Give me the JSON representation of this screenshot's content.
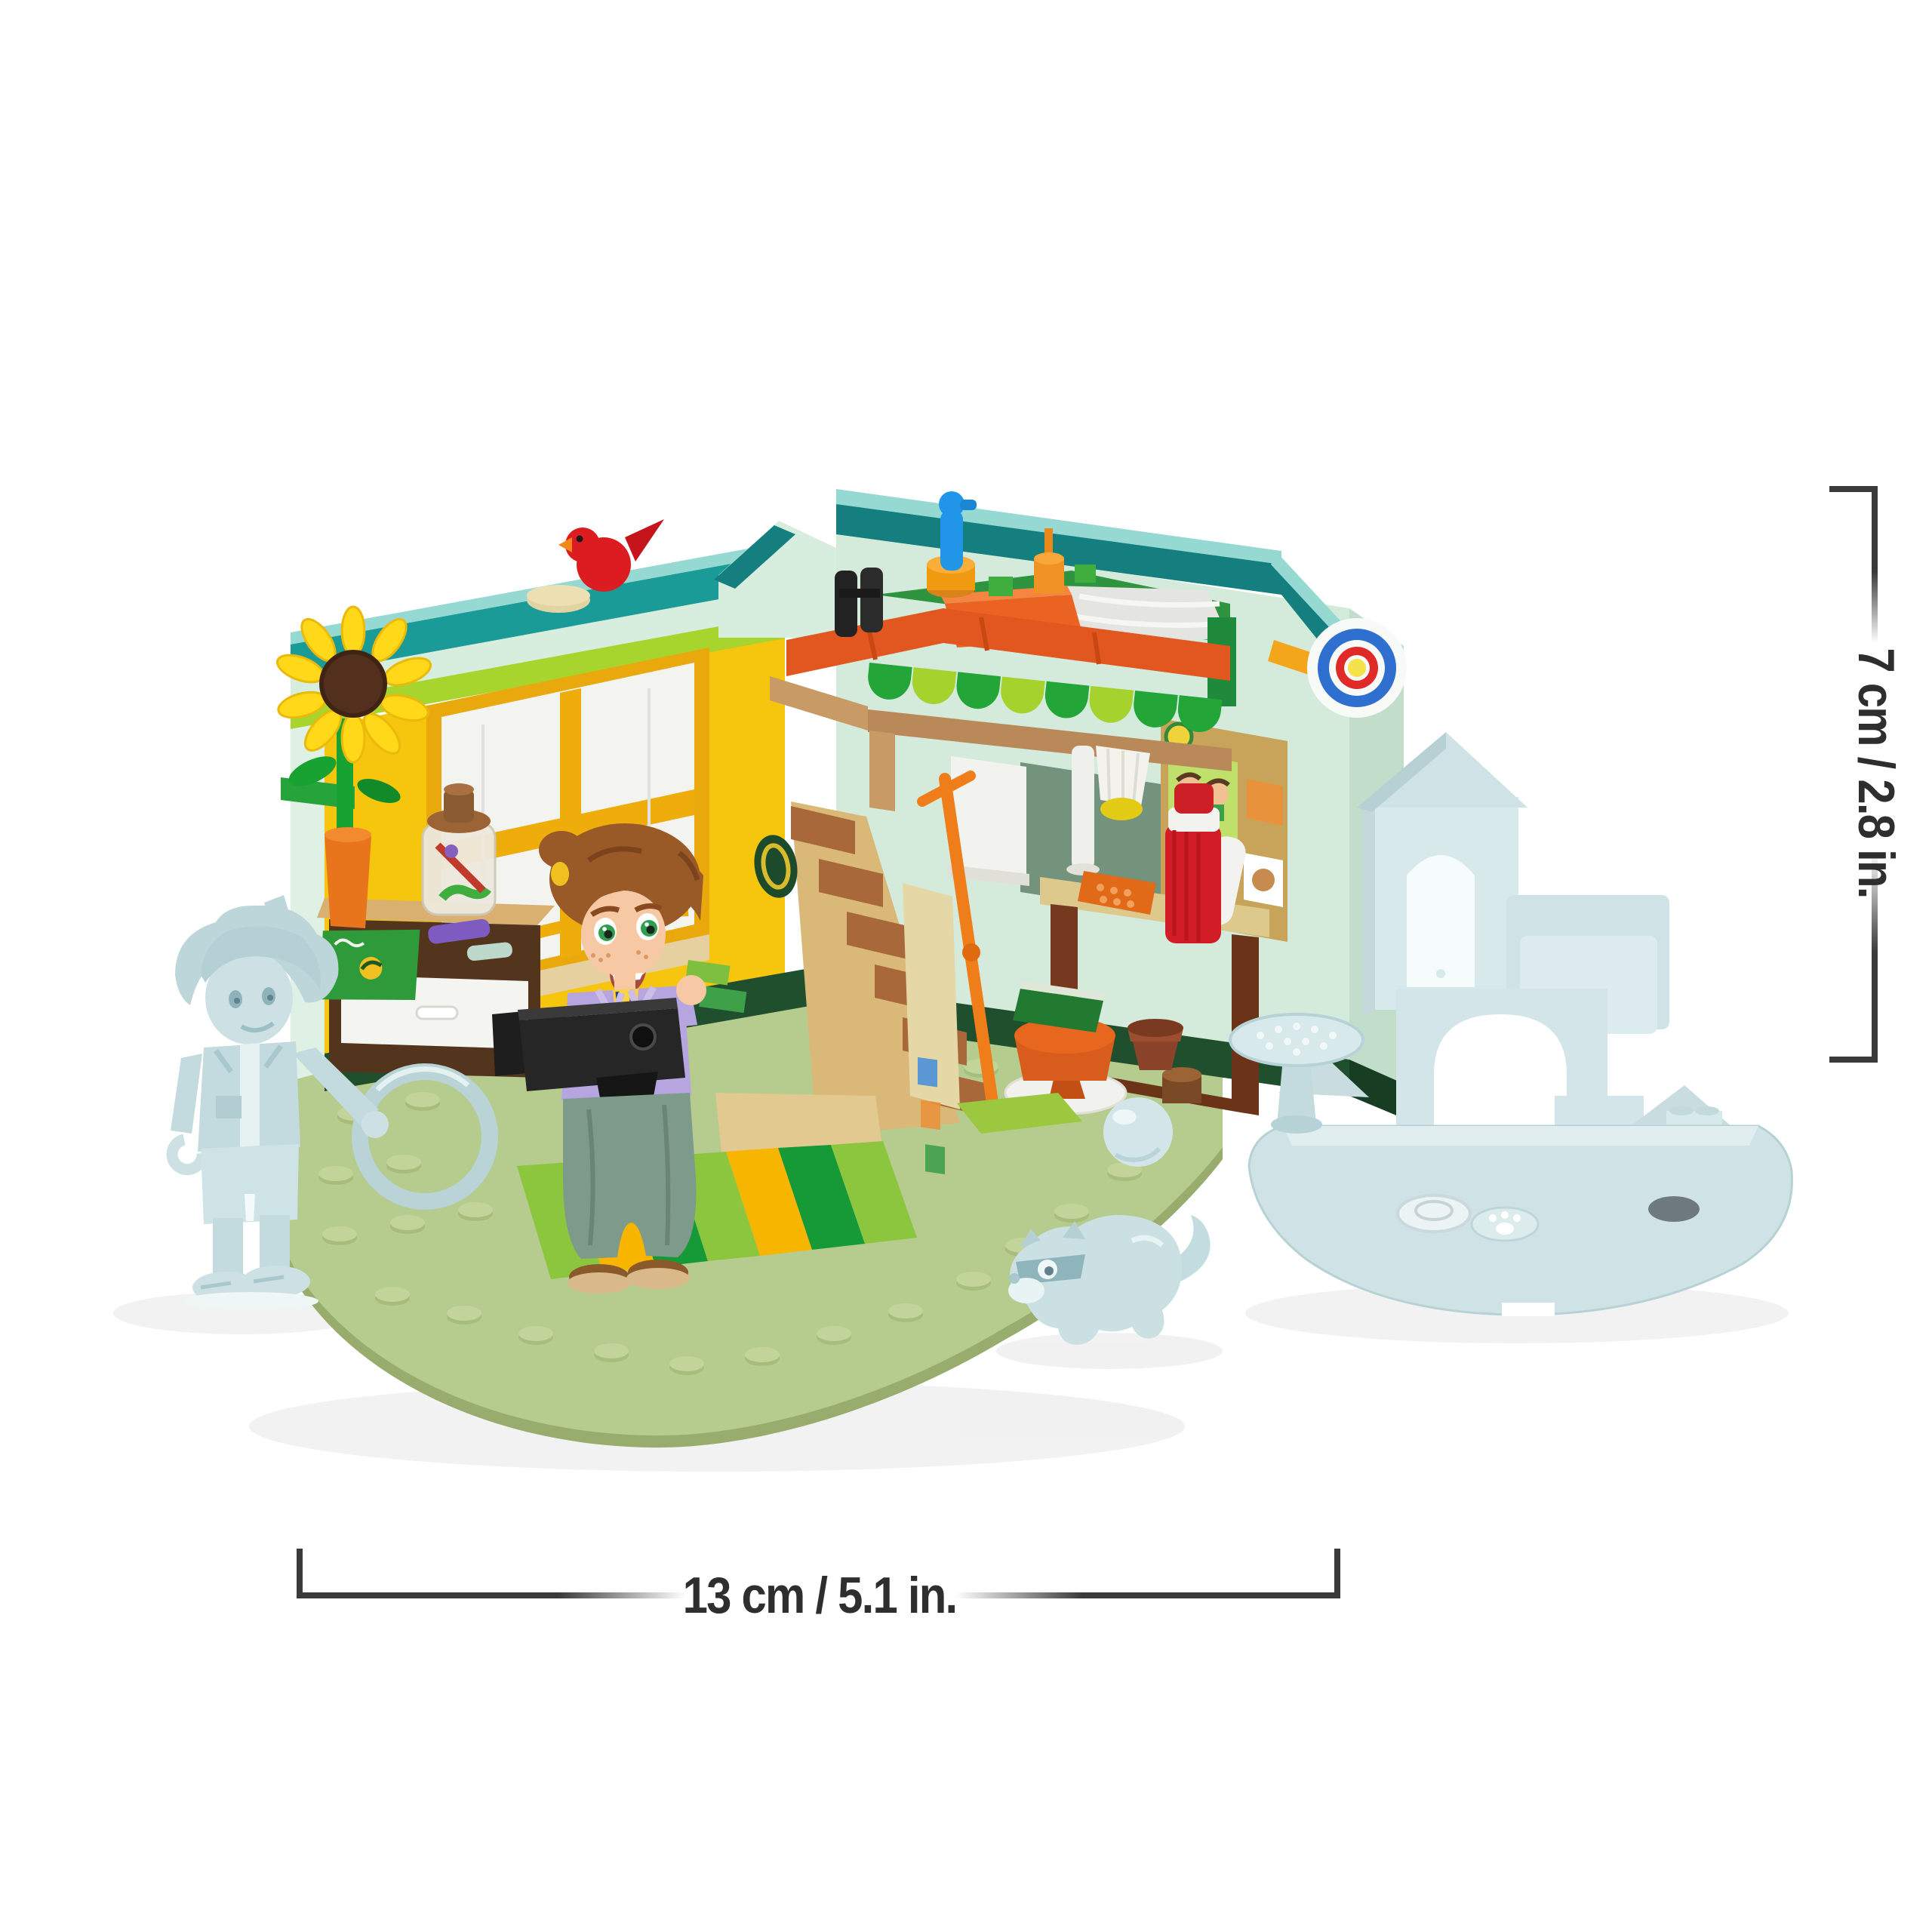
{
  "image": {
    "kind": "product-dimensions-photo",
    "background": "#ffffff",
    "subject": "LEGO Friends style bedroom playset with mini-doll photographer, translucent preview boy figure with hoop, translucent ferret and ball, and translucent rocking-castle build"
  },
  "annotations": {
    "height_label": "7 cm / 2.8 in.",
    "width_label": "13 cm / 5.1 in.",
    "line_color": "#3a3a3a",
    "text_color": "#2e2e2e"
  },
  "scene": {
    "objects": [
      "base-plate",
      "left-wall-with-bay-window",
      "corner-gable",
      "right-wall",
      "photo-collage",
      "archery-target",
      "loft-bed",
      "awning-scallops",
      "bed-blanket",
      "binoculars",
      "blue-statue",
      "staircase",
      "orange-pole",
      "roller-blind",
      "table-lamp",
      "desk",
      "thermos",
      "orange-phone",
      "stool-with-book",
      "white-rug",
      "barrel",
      "drawer-unit",
      "storage-jar",
      "green-notebook",
      "sunflower",
      "red-bird",
      "striped-rug",
      "mini-doll-figure",
      "camera",
      "ghost-boy-figure",
      "ghost-ring",
      "ghost-ball",
      "ghost-ferret",
      "flower-pot",
      "ghost-rocking-castle",
      "ghost-round-table",
      "paw-print-tile",
      "clear-round-tile"
    ],
    "palette": {
      "roof_teal": "#1b9b98",
      "roof_teal_dark": "#157f7f",
      "roof_aqua": "#95d9d2",
      "wall_mint": "#d7eede",
      "wall_yellow": "#f6c50e",
      "trim_lime": "#a8d42e",
      "baseboard_green": "#1f4f2c",
      "loft_orange": "#e2571f",
      "awning_green": "#23a538",
      "awning_lime": "#a6d22e",
      "stairs_brown": "#a8683a",
      "stairs_tan": "#d9b878",
      "floor_sage": "#b6cc8e",
      "rug_green": "#169a38",
      "rug_yellow": "#f7b500",
      "rug_lime": "#8cc63f",
      "ghost_blue": "#c9dee1",
      "target_blue": "#2f6fd0",
      "target_red": "#e02a28",
      "target_yellow": "#f5e14a",
      "bird_red": "#dd1c22",
      "thermos_red": "#d21d26",
      "hair_auburn": "#9a5a28",
      "vest_lavender": "#b7a5df",
      "pants_sage": "#7e9a8a"
    }
  }
}
